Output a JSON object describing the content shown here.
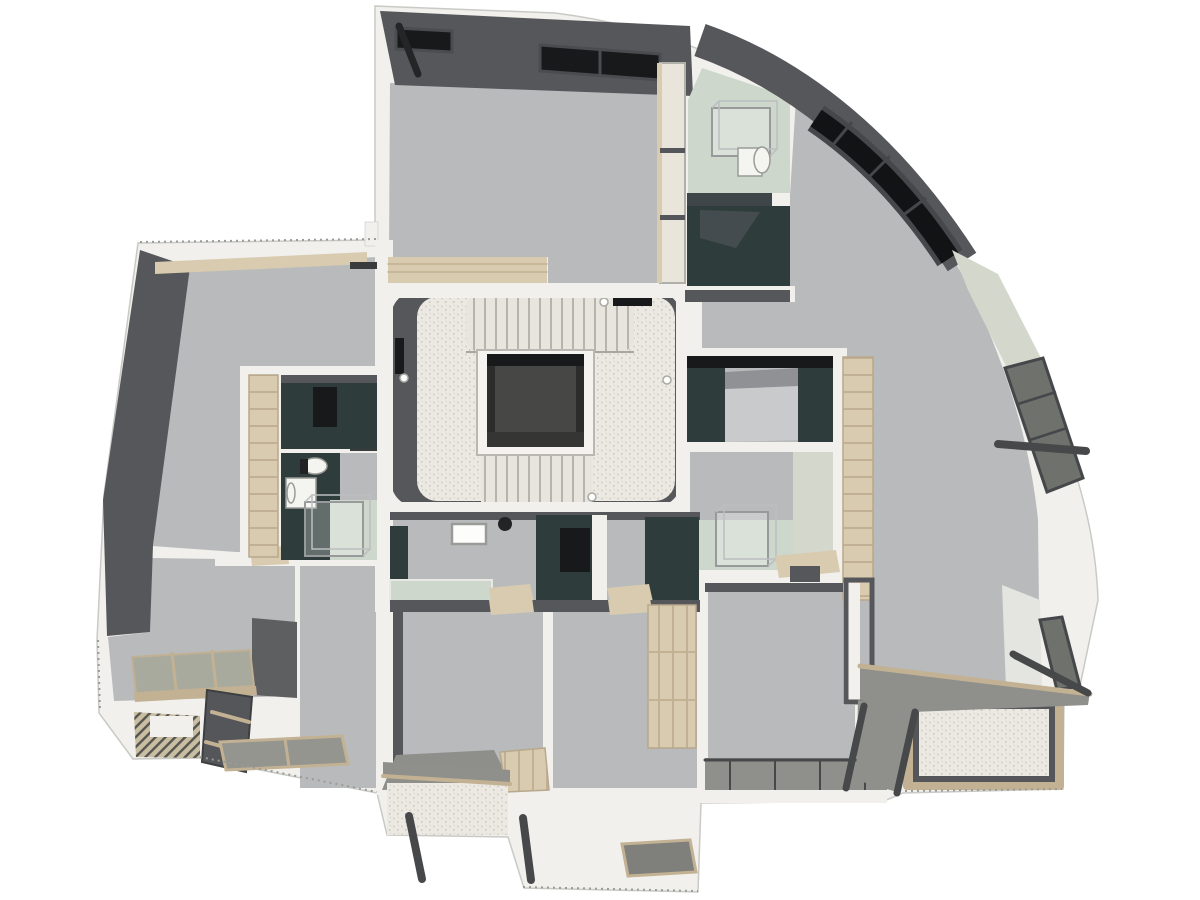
{
  "image": {
    "kind": "architectural-floor-plan-3d-render",
    "view": "top-down",
    "visible_text": "none"
  },
  "palette": {
    "bg": "#ffffff",
    "wallWhite": "#f1f0ec",
    "wallEdge": "#c9c9c5",
    "floor": "#b9babc",
    "darkWall": "#56575b",
    "darkWall2": "#5d5f61",
    "teal": "#2e3d3b",
    "winBlack": "#17191b",
    "winGlass": "#6f716c",
    "winFrame": "#45474b",
    "wood": "#d8cbb0",
    "woodDeep": "#c3b193",
    "woodLine": "#c2b094",
    "cream": "#e9e5da",
    "sage": "#cdd7cb",
    "sageWall": "#d4d8cc",
    "terrazzo": "#ebe9e2",
    "speck": "#d3d0c6",
    "treadBase": "#e7e5dd",
    "treadLine": "#b6b4ab",
    "canopy": "#8f908b",
    "rail": "#47484a",
    "matGray": "#94958f",
    "slat": "#a9aa9e"
  },
  "regions": {
    "core": {
      "fixtures": [
        "stairs-upper-flight",
        "stairs-lower-flight",
        "elevator-shaft",
        "door-stop-dots"
      ]
    },
    "bedroom_north": {
      "fixtures": [
        "window-strips",
        "wardrobe",
        "wood-threshold",
        "door-leaf"
      ]
    },
    "bathroom_northeast": {
      "fixtures": [
        "glass-shower",
        "sink",
        "mirror",
        "counter"
      ]
    },
    "kitchenette_northeast": {
      "fixtures": [
        "dark-counter"
      ]
    },
    "living_room_east": {
      "fixtures": [
        "curved-window-band",
        "facade-window-upper",
        "facade-window-lower",
        "ledge-rail"
      ]
    },
    "bed_alcove_east": {
      "fixtures": [
        "bed",
        "teal-headboard-walls"
      ]
    },
    "bathroom_east": {
      "fixtures": [
        "glass-shower",
        "sage-wall",
        "wood-threshold",
        "wardrobe"
      ]
    },
    "living_room_west": {
      "fixtures": [
        "wood-beam",
        "wall-shelves",
        "wardrobe-strip"
      ]
    },
    "walk_in_closet_west": {
      "fixtures": [
        "dark-cabinet"
      ]
    },
    "bathroom_west": {
      "fixtures": [
        "toilet",
        "sink",
        "mirror",
        "glass-shower"
      ]
    },
    "bedroom_southwest": {
      "fixtures": [
        "slatted-bench",
        "tilted-glazing-panel"
      ]
    },
    "hallway_south": {
      "fixtures": [
        "laundry-counter",
        "whiteboard",
        "tall-cabinets",
        "wood-thresholds",
        "basin"
      ]
    },
    "bedroom_south_left": {
      "fixtures": [
        "desk",
        "wood-cabinet"
      ]
    },
    "bedroom_south_right": {
      "fixtures": [
        "wardrobe"
      ]
    },
    "bedroom_southeast": {
      "fixtures": [
        "glazed-door-frame"
      ]
    },
    "terrace_southwest": {
      "fixtures": [
        "deck-mats",
        "louvered-pergola-deck"
      ]
    },
    "balcony_south_left": {
      "fixtures": [
        "canopy",
        "railing-posts",
        "speckled-deck"
      ]
    },
    "terrace_south": {
      "fixtures": [
        "skylight-mat",
        "railing-post"
      ]
    },
    "balcony_south_right": {
      "fixtures": [
        "canopy-deck",
        "railing-grid"
      ]
    },
    "terrace_east": {
      "fixtures": [
        "wood-frame",
        "speckled-deck",
        "sloped-canopies",
        "railing-bars",
        "facade-window"
      ]
    }
  }
}
